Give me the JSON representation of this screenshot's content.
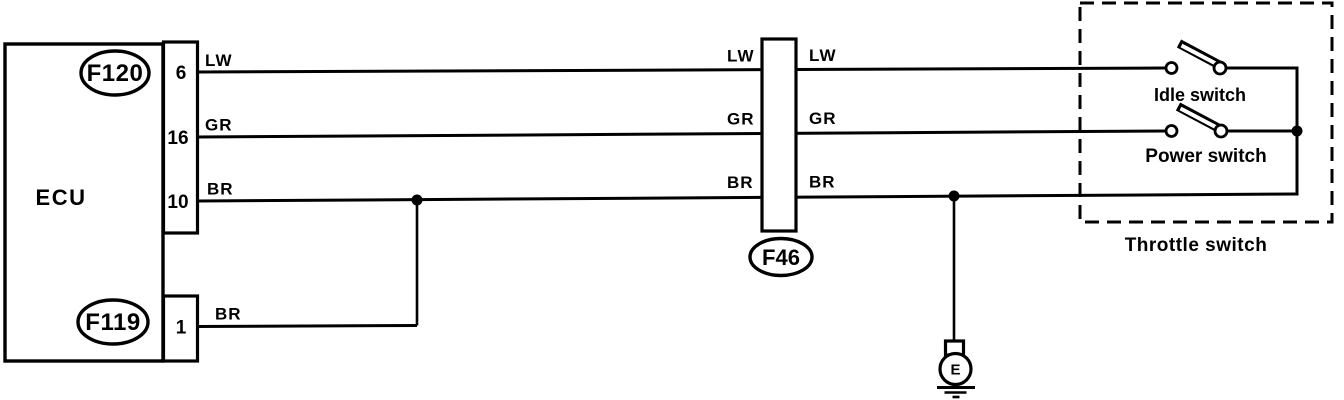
{
  "ecu": {
    "label": "ECU",
    "connector_top_id": "F120",
    "connector_bottom_id": "F119",
    "pins": [
      {
        "number": "6",
        "wire": "LW"
      },
      {
        "number": "16",
        "wire": "GR"
      },
      {
        "number": "10",
        "wire": "BR"
      },
      {
        "number": "1",
        "wire": "BR"
      }
    ]
  },
  "inline_connector": {
    "id": "F46",
    "left_wire_labels": [
      "LW",
      "GR",
      "BR"
    ],
    "right_wire_labels": [
      "LW",
      "GR",
      "BR"
    ]
  },
  "throttle_switch_box": {
    "label": "Throttle switch",
    "switches": [
      {
        "label": "Idle switch"
      },
      {
        "label": "Power switch"
      }
    ]
  },
  "ground": {
    "label": "E"
  },
  "colors": {
    "ink": "#000000",
    "paper": "#ffffff"
  }
}
